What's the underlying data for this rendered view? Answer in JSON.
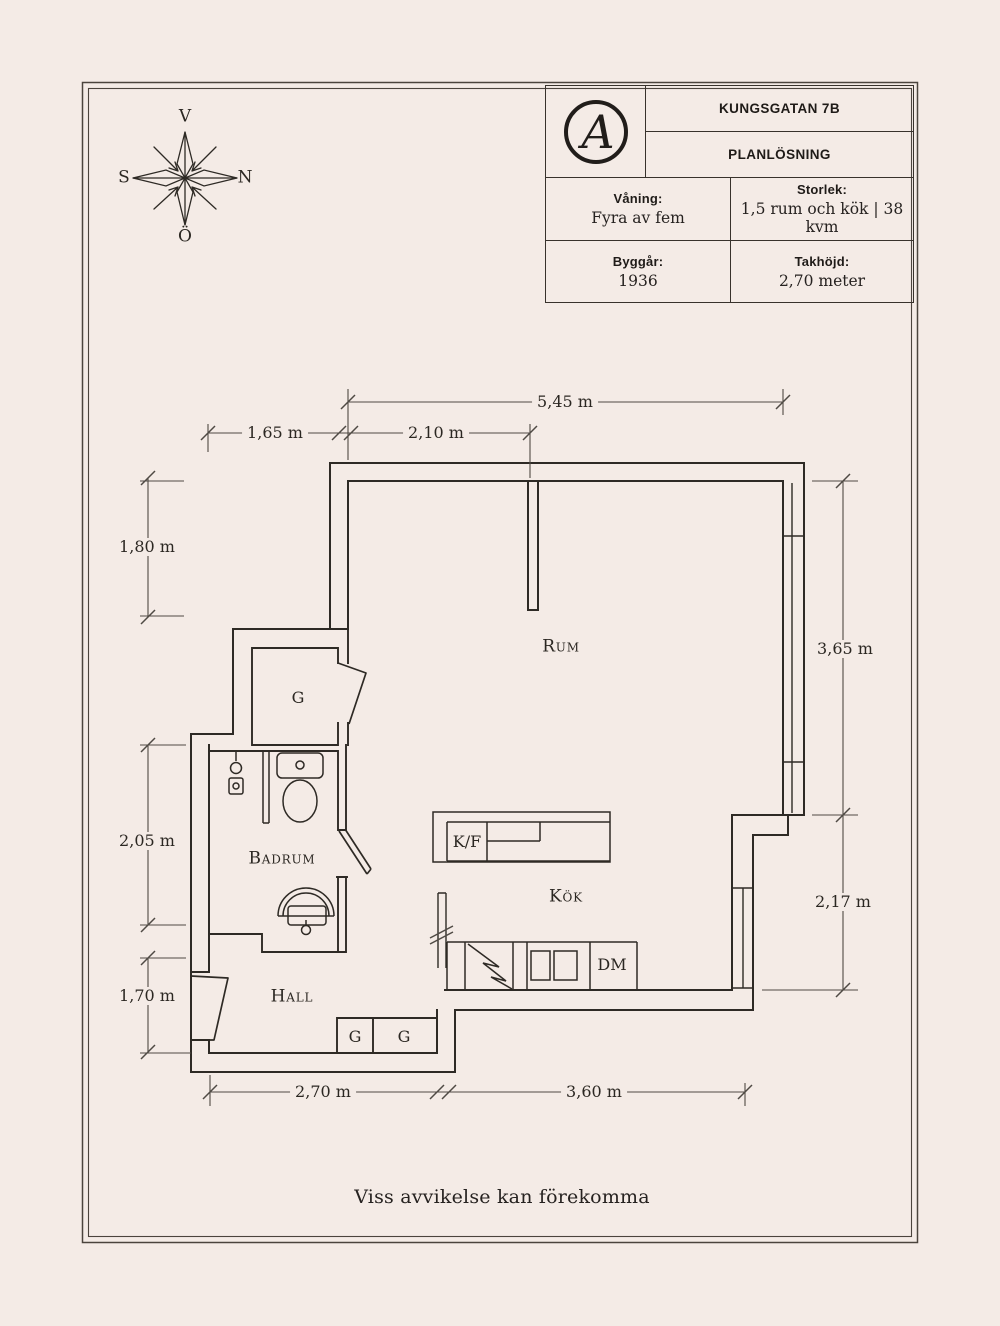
{
  "page": {
    "background_color": "#f4ebe6",
    "ink_color": "#2e2a25",
    "footer_note": "Viss avvikelse kan förekomma"
  },
  "compass": {
    "top": "V",
    "right": "N",
    "left": "S",
    "bottom": "Ö"
  },
  "title_block": {
    "logo_monogram": "A",
    "address": "KUNGSGATAN 7B",
    "drawing_type": "PLANLÖSNING",
    "cells": [
      {
        "label": "Våning:",
        "value": "Fyra av fem"
      },
      {
        "label": "Storlek:",
        "value": "1,5 rum och kök | 38 kvm"
      },
      {
        "label": "Byggår:",
        "value": "1936"
      },
      {
        "label": "Takhöjd:",
        "value": "2,70 meter"
      }
    ]
  },
  "floor_plan": {
    "room_labels": {
      "rum": "Rum",
      "kok": "Kök",
      "hall": "Hall",
      "badrum": "Badrum"
    },
    "fixture_labels": {
      "wardrobe1": "G",
      "wardrobe2": "G",
      "wardrobe3": "G",
      "fridge_freezer": "K/F",
      "dishwasher": "DM"
    },
    "dimensions": {
      "top_total": "5,45 m",
      "top_left": "1,65 m",
      "top_mid": "2,10 m",
      "left_upper": "1,80 m",
      "left_middle": "2,05 m",
      "left_lower": "1,70 m",
      "right_upper": "3,65 m",
      "right_lower": "2,17 m",
      "bottom_left": "2,70 m",
      "bottom_right": "3,60 m"
    }
  }
}
